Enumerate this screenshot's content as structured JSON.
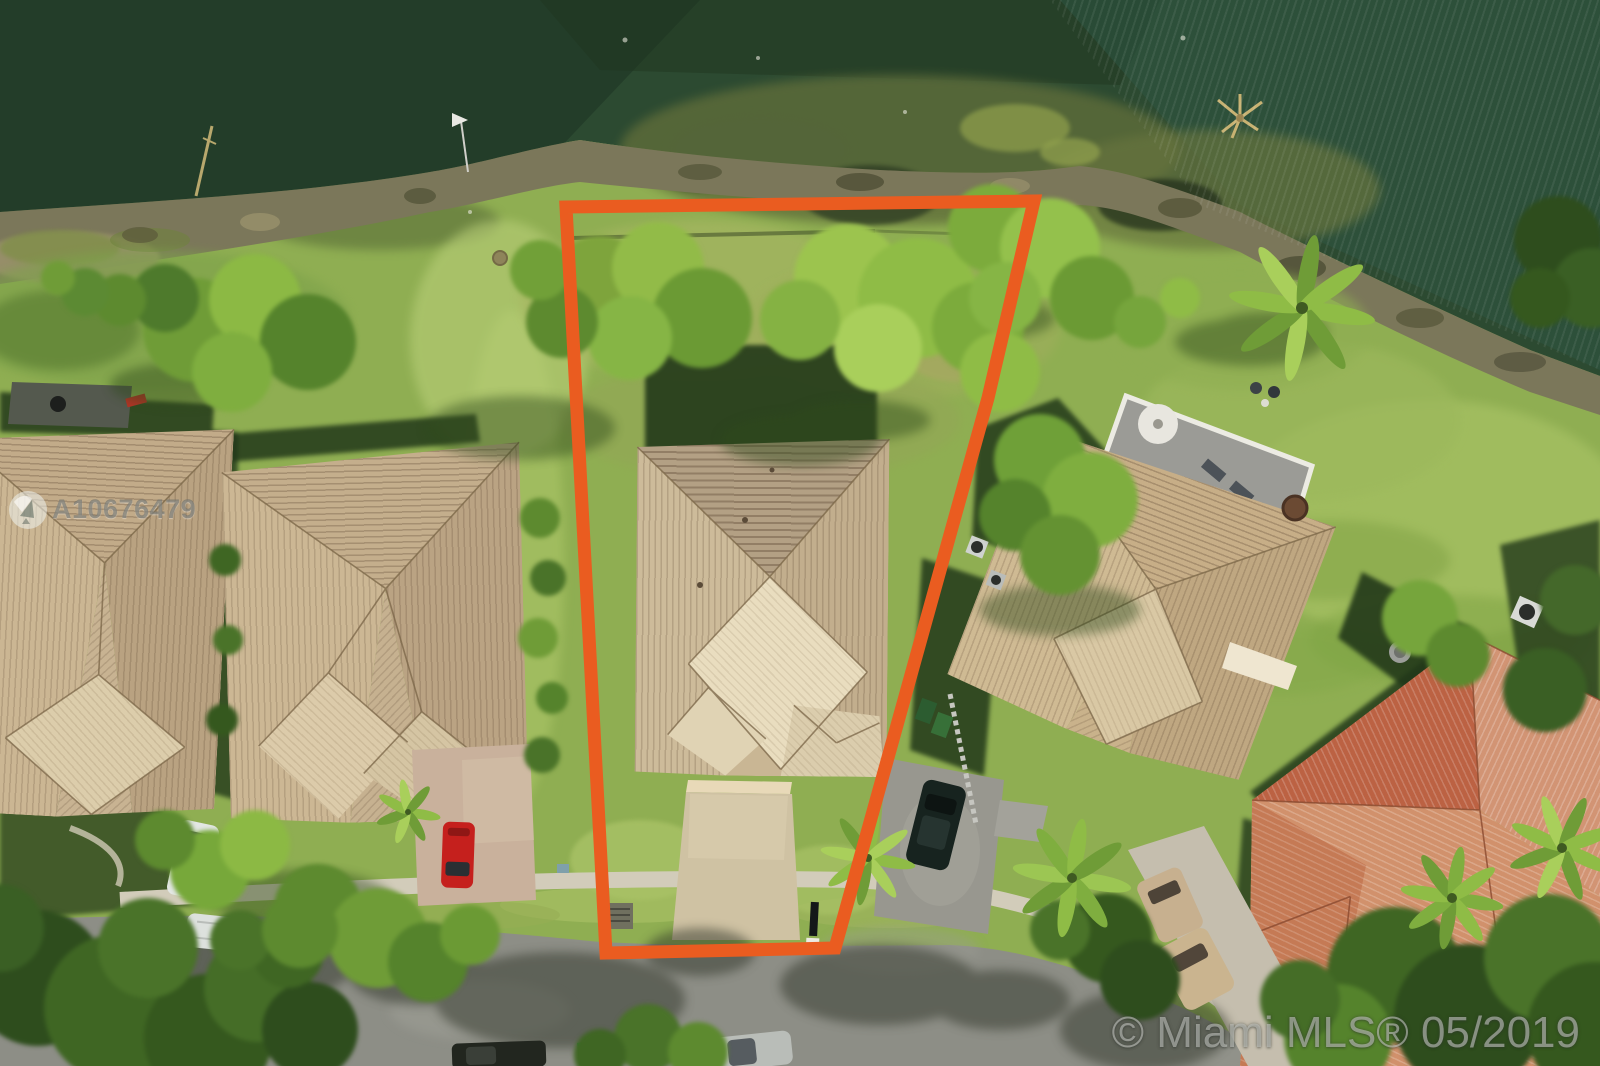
{
  "photo": {
    "type": "aerial-drone-photo",
    "subject": "waterfront single-family lot outlined in orange",
    "boundary_color": "#ea5c20"
  },
  "watermarks": {
    "mls_number": "A10676479",
    "copyright": "© Miami MLS® 05/2019"
  },
  "palette": {
    "water": "#2c4a31",
    "algae": "#5f6d3a",
    "shore_rock": "#7b775a",
    "grass": "#8fae52",
    "tan_roof": "#c8b291",
    "red_roof": "#c4714d",
    "street": "#8d8e86",
    "sidewalk": "#d2ccba",
    "driveway": "#cfc1a2"
  },
  "objects": [
    "lake",
    "shoreline",
    "subject-lot-boundary",
    "subject-house",
    "left-house",
    "far-left-house",
    "right-house",
    "far-right-house",
    "street",
    "sidewalk",
    "red-car",
    "white-car",
    "white-suv",
    "dark-car",
    "silver-car",
    "teal-car",
    "tan-suv",
    "tan-sedan",
    "mailbox",
    "palm-trees"
  ]
}
